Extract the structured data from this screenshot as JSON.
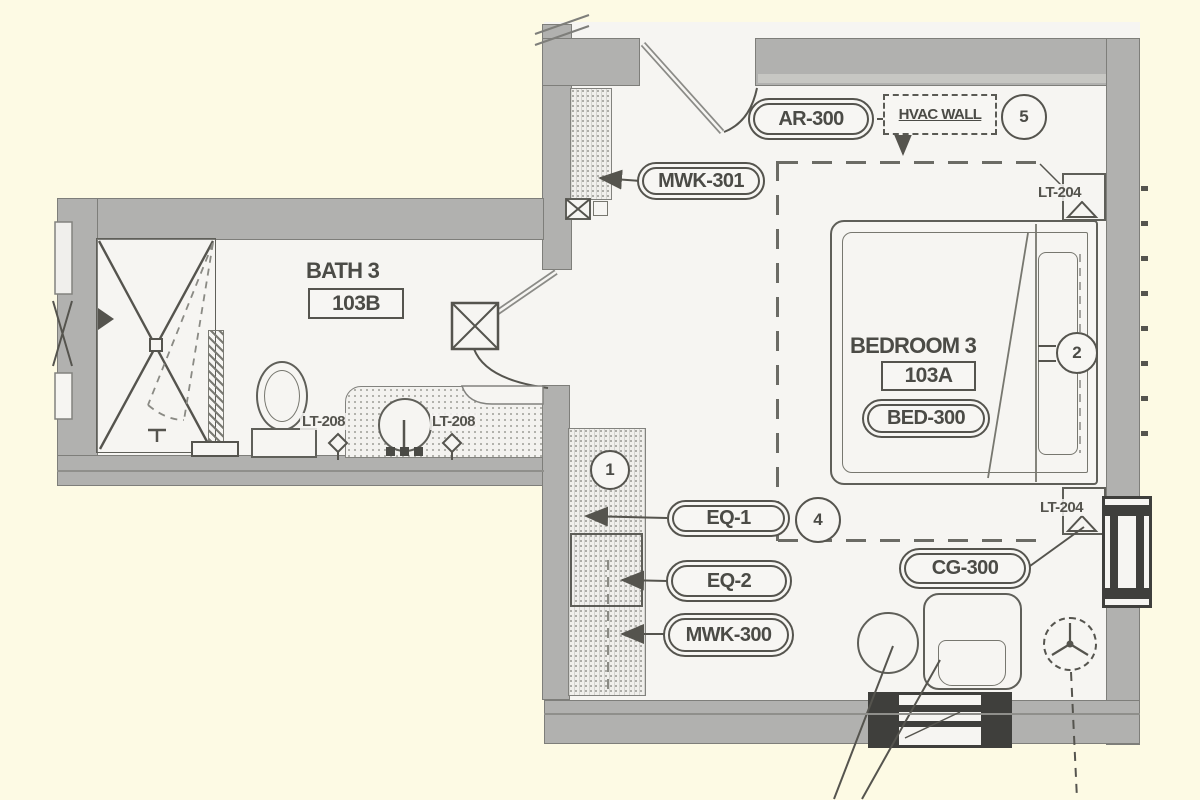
{
  "plan": {
    "rooms": {
      "bath": {
        "name": "BATH 3",
        "number": "103B"
      },
      "bedroom": {
        "name": "BEDROOM 3",
        "number": "103A"
      }
    },
    "tags": {
      "ar300": "AR-300",
      "mwk301": "MWK-301",
      "hvac": "HVAC WALL",
      "bed300": "BED-300",
      "eq1": "EQ-1",
      "eq2": "EQ-2",
      "mwk300": "MWK-300",
      "cg300": "CG-300",
      "lt204_top": "LT-204",
      "lt204_bottom": "LT-204",
      "lt208_left": "LT-208",
      "lt208_right": "LT-208"
    },
    "keynotes": {
      "one": "1",
      "two": "2",
      "four": "4",
      "five": "5"
    },
    "colors": {
      "background": "#FDFAE4",
      "wall": "#B1B1AF",
      "line": "#55544E",
      "floor": "#F6F5F2",
      "window_dark": "#3F3F3C"
    }
  }
}
